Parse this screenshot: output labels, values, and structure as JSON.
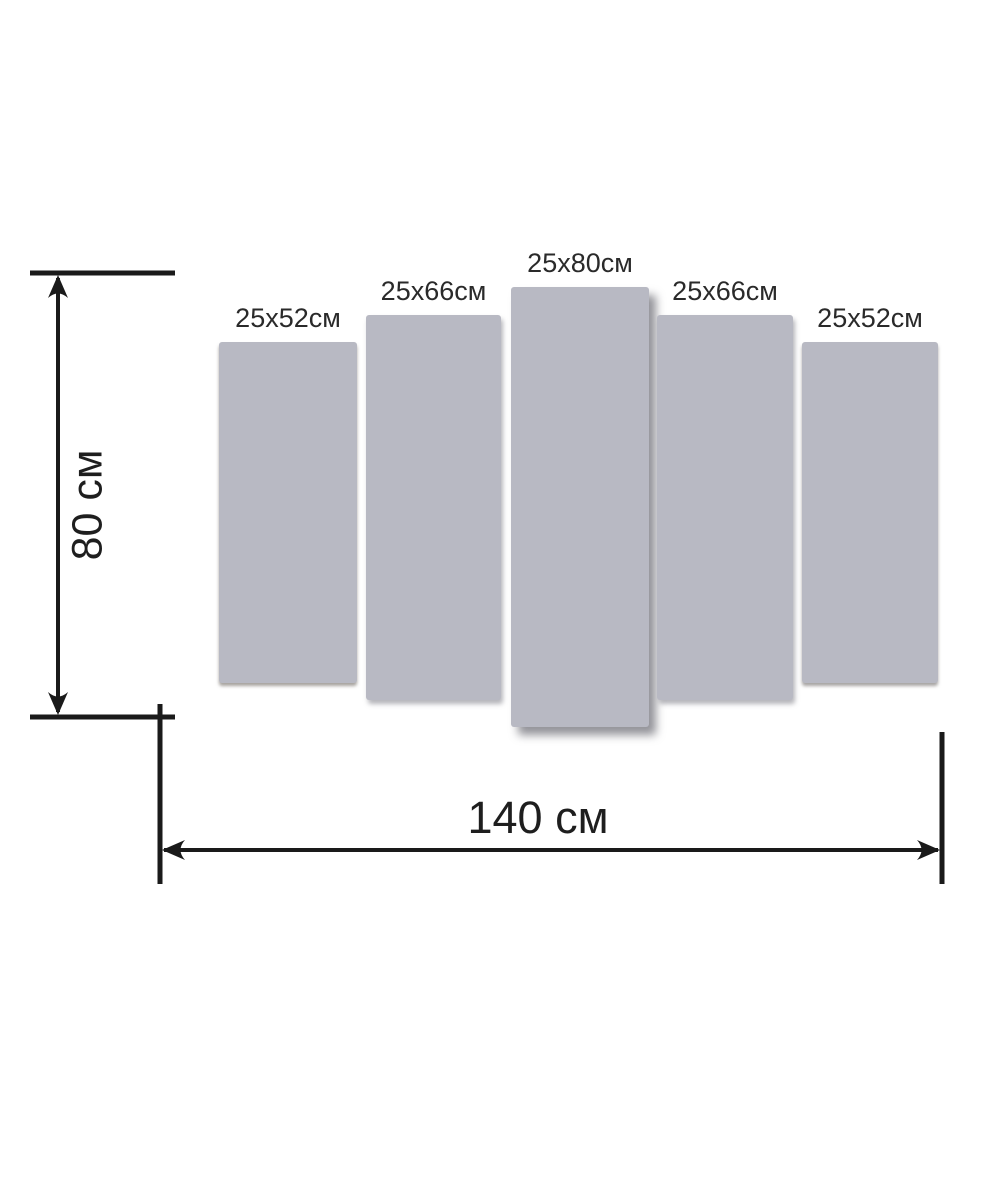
{
  "diagram_type": "modular-wall-art-panel-size-diagram",
  "panels": [
    {
      "id": 1,
      "label": "25x52см",
      "width_cm": 25,
      "height_cm": 52
    },
    {
      "id": 2,
      "label": "25x66см",
      "width_cm": 25,
      "height_cm": 66
    },
    {
      "id": 3,
      "label": "25x80см",
      "width_cm": 25,
      "height_cm": 80
    },
    {
      "id": 4,
      "label": "25x66см",
      "width_cm": 25,
      "height_cm": 66
    },
    {
      "id": 5,
      "label": "25x52см",
      "width_cm": 25,
      "height_cm": 52
    }
  ],
  "dimensions": {
    "total_height": {
      "label": "80 см",
      "value_cm": 80
    },
    "total_width": {
      "label": "140 см",
      "value_cm": 140
    }
  },
  "colors": {
    "background": "#ffffff",
    "panel_fill": "#b8b9c3",
    "line_color": "#1a1a1a",
    "text_color": "#2a2a2a",
    "dim_text_color": "#1e1e1e"
  }
}
